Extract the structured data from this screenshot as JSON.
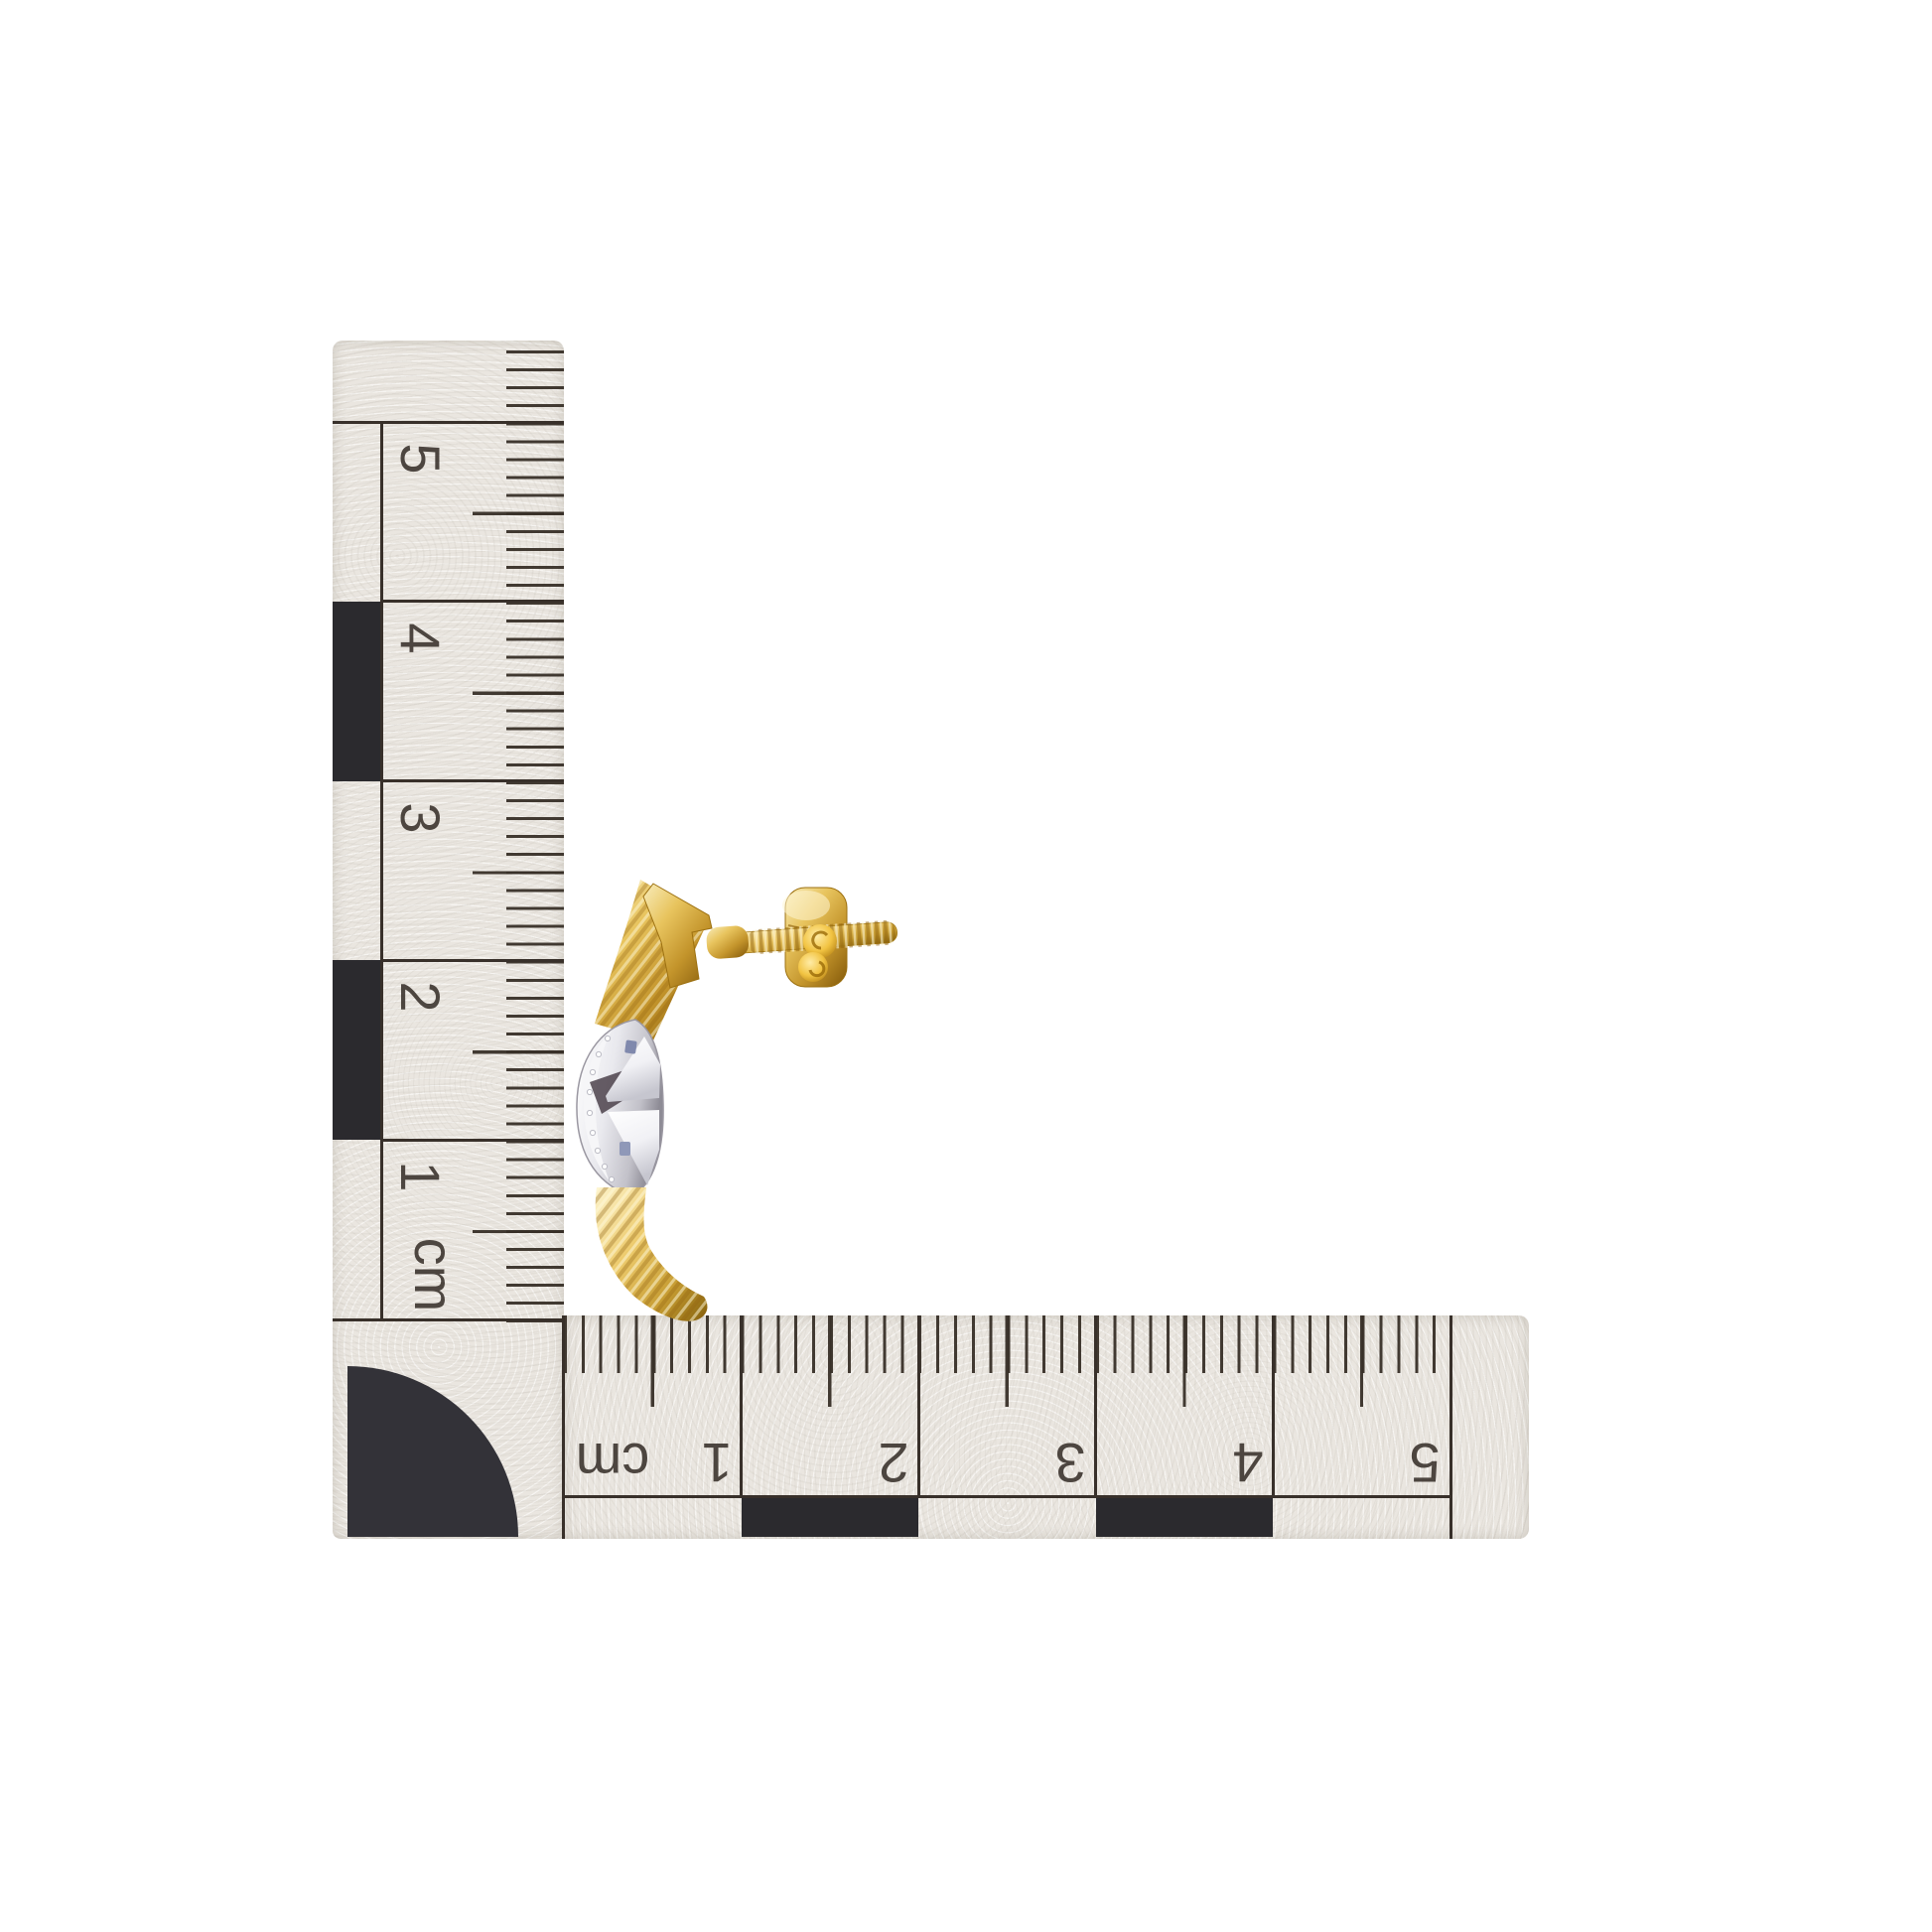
{
  "scene": {
    "background_color": "#ffffff",
    "subject": "two-tone gold and white-gold half-hoop earring with threaded screw post and screw-back",
    "ruler_paper_color": "#eae6e0",
    "ruler_ink_color": "#38302a",
    "ruler_block_color": "#2b2a2e"
  },
  "vertical_ruler": {
    "unit_label": "cm",
    "tick_labels": [
      "5",
      "4",
      "3",
      "2",
      "1"
    ]
  },
  "horizontal_ruler": {
    "unit_label": "cm",
    "tick_labels": [
      "1",
      "2",
      "3",
      "4",
      "5"
    ]
  },
  "earring": {
    "gold_color": "#d9a93b",
    "gold_highlight": "#f7ecc0",
    "gold_shadow": "#a0720e",
    "white_gold_color": "#ededf0",
    "white_gold_shadow": "#97949e",
    "accent_glint_color": "#8089ad"
  }
}
